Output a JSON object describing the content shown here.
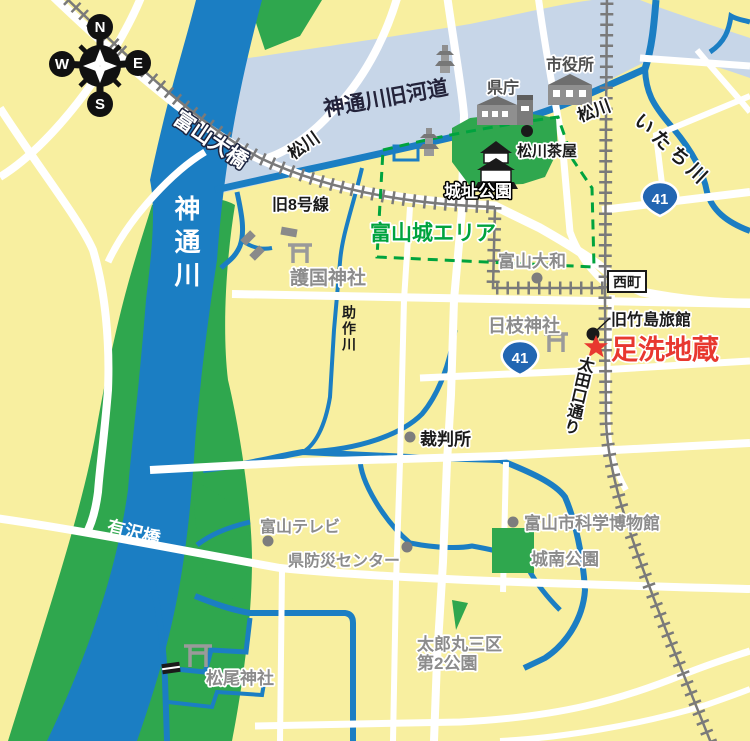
{
  "compass": {
    "n": "N",
    "e": "E",
    "s": "S",
    "w": "W"
  },
  "waterways": {
    "jinzu_river": "神通川",
    "old_channel": "神通川旧河道",
    "matsukawa": "松川",
    "itachi_river": "いたち川",
    "sukesaku_river": "助作川"
  },
  "bridges": {
    "toyama_ohashi": "富山大橋",
    "arisawa_bashi": "有沢橋"
  },
  "roads": {
    "old_route_8": "旧8号線",
    "otaguchi_dori": "太田口通り",
    "nishicho": "西町",
    "route_41": "41"
  },
  "areas": {
    "joshi_park": "城址公園",
    "toyama_castle_area": "富山城エリア",
    "jonan_park": "城南公園",
    "taromaru_park_line1": "太郎丸三区",
    "taromaru_park_line2": "第2公園"
  },
  "landmarks": {
    "prefectural_office": "県庁",
    "city_hall": "市役所",
    "matsukawa_chaya": "松川茶屋",
    "toyama_daiwa": "富山大和",
    "gokoku_shrine": "護国神社",
    "hie_shrine": "日枝神社",
    "former_takeshima_ryokan": "旧竹島旅館",
    "ashiarai_jizo": "足洗地蔵",
    "courthouse": "裁判所",
    "toyama_tv": "富山テレビ",
    "disaster_center": "県防災センター",
    "science_museum": "富山市科学博物館",
    "matsuo_shrine": "松尾神社"
  },
  "colors": {
    "background": "#F8EFA0",
    "river": "#1B7EC3",
    "bank_green": "#2FA74E",
    "old_channel": "#C7D6E8",
    "road": "#FFFFFF",
    "railway": "#7A7A7A",
    "area_boundary": "#00A33E",
    "highlight_red": "#E8382F",
    "route_shield": "#2266B2"
  }
}
